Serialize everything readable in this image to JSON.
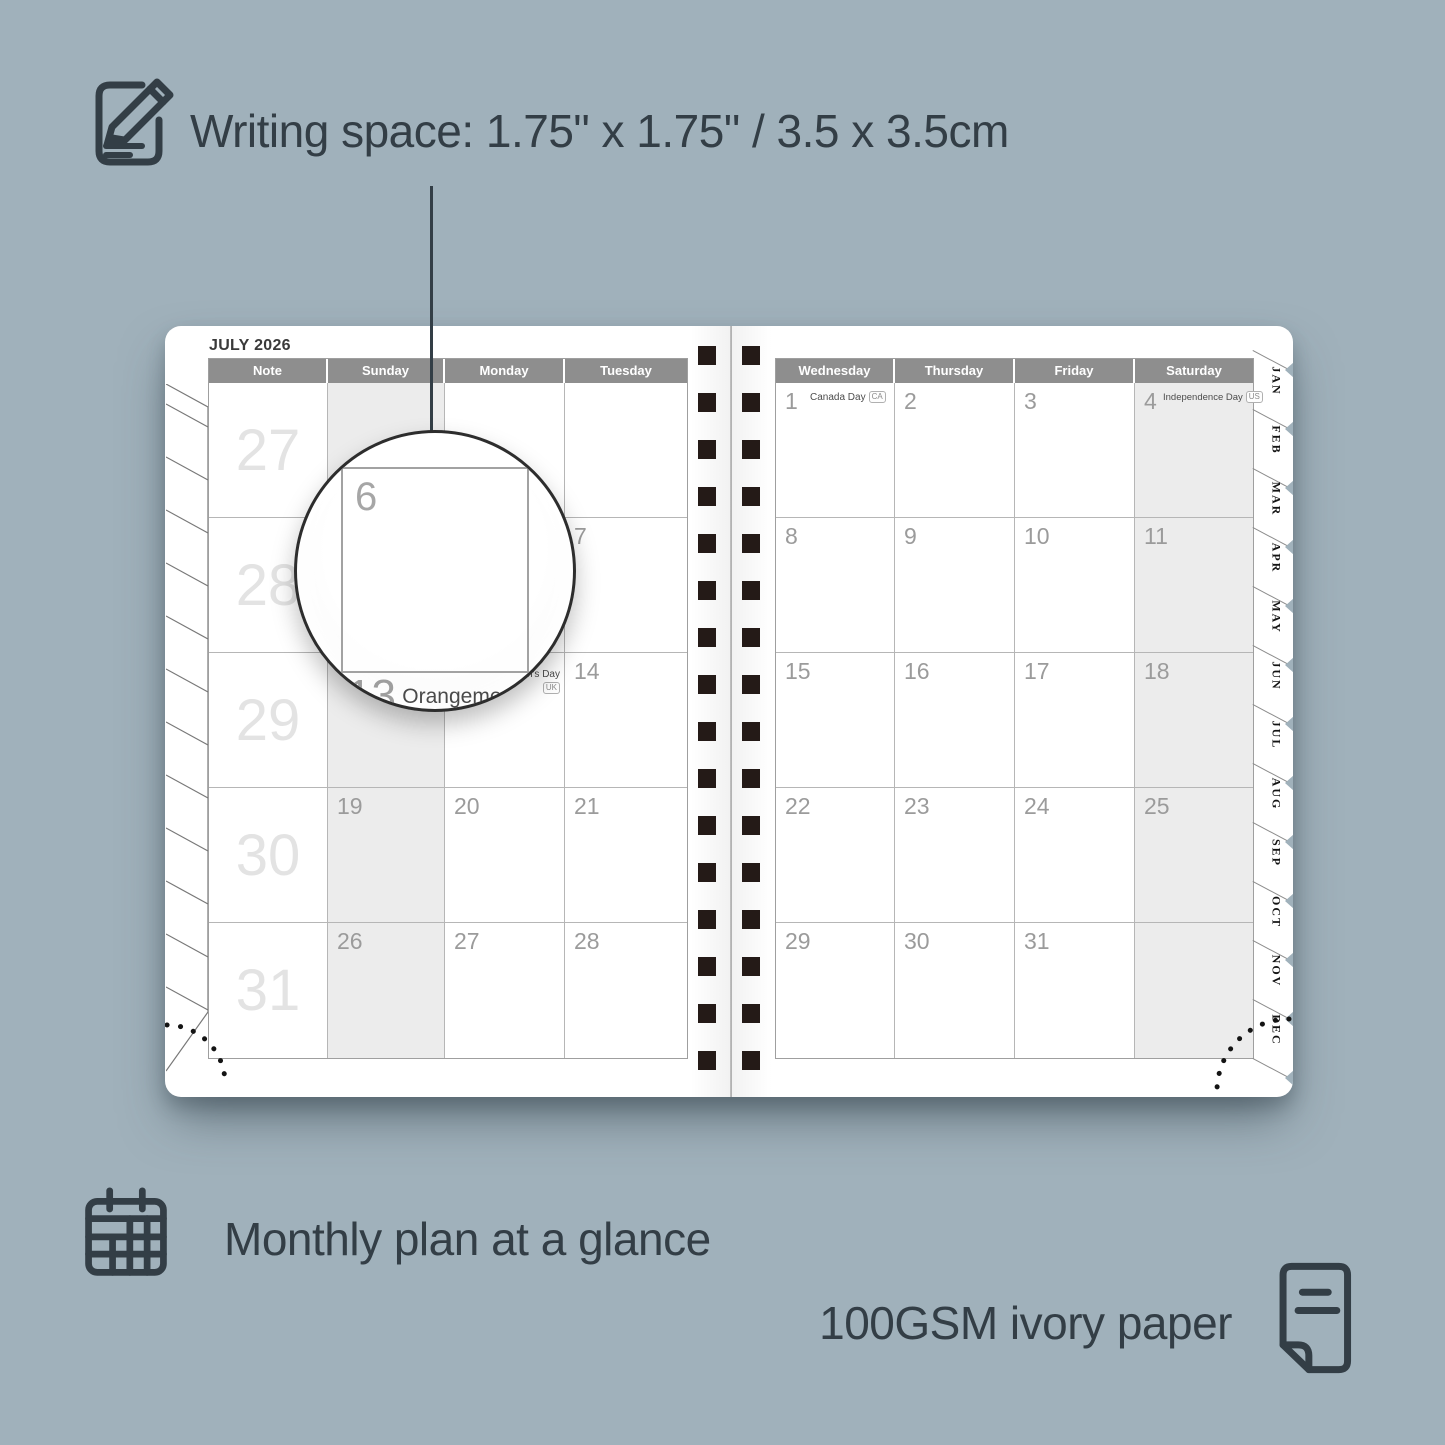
{
  "colors": {
    "background": "#a0b1bb",
    "ink": "#333e46",
    "header_row": "#8e8e8e",
    "shaded_cell": "#ececec",
    "date_number": "#9b9b9b",
    "week_number": "#e3e3e3",
    "spiral_binding": "#241a17"
  },
  "features": {
    "writing_space": {
      "icon": "note-pencil-icon",
      "text": "Writing space: 1.75\" x 1.75\" / 3.5 x 3.5cm"
    },
    "monthly_plan": {
      "icon": "calendar-grid-icon",
      "text": "Monthly plan at a glance"
    },
    "paper": {
      "icon": "paper-sheet-icon",
      "text": "100GSM ivory paper"
    }
  },
  "planner": {
    "title": "JULY 2026",
    "left_page": {
      "headers": [
        "Note",
        "Sunday",
        "Monday",
        "Tuesday"
      ],
      "shaded_column": "Sunday",
      "rows": [
        {
          "week": "27",
          "days": [
            {
              "d": ""
            },
            {
              "d": ""
            },
            {
              "d": ""
            }
          ]
        },
        {
          "week": "28",
          "days": [
            {
              "d": ""
            },
            {
              "d": "6"
            },
            {
              "d": "7"
            }
          ]
        },
        {
          "week": "29",
          "days": [
            {
              "d": ""
            },
            {
              "d": "13",
              "holiday": "Orangemen's Day",
              "badge": "UK"
            },
            {
              "d": "14"
            }
          ]
        },
        {
          "week": "30",
          "days": [
            {
              "d": "19"
            },
            {
              "d": "20"
            },
            {
              "d": "21"
            }
          ]
        },
        {
          "week": "31",
          "days": [
            {
              "d": "26"
            },
            {
              "d": "27"
            },
            {
              "d": "28"
            }
          ]
        }
      ]
    },
    "right_page": {
      "headers": [
        "Wednesday",
        "Thursday",
        "Friday",
        "Saturday"
      ],
      "shaded_column": "Saturday",
      "rows": [
        {
          "days": [
            {
              "d": "1",
              "holiday": "Canada Day",
              "badge": "CA"
            },
            {
              "d": "2"
            },
            {
              "d": "3"
            },
            {
              "d": "4",
              "holiday": "Independence Day",
              "badge": "US",
              "small": true
            }
          ]
        },
        {
          "days": [
            {
              "d": "8"
            },
            {
              "d": "9"
            },
            {
              "d": "10"
            },
            {
              "d": "11"
            }
          ]
        },
        {
          "days": [
            {
              "d": "15"
            },
            {
              "d": "16"
            },
            {
              "d": "17"
            },
            {
              "d": "18"
            }
          ]
        },
        {
          "days": [
            {
              "d": "22"
            },
            {
              "d": "23"
            },
            {
              "d": "24"
            },
            {
              "d": "25"
            }
          ]
        },
        {
          "days": [
            {
              "d": "29"
            },
            {
              "d": "30"
            },
            {
              "d": "31"
            },
            {
              "d": ""
            }
          ]
        }
      ]
    },
    "month_tabs": [
      "JAN",
      "FEB",
      "MAR",
      "APR",
      "MAY",
      "JUN",
      "JUL",
      "AUG",
      "SEP",
      "OCT",
      "NOV",
      "DEC"
    ],
    "magnifier": {
      "top_day": "6",
      "bottom_day": "13",
      "holiday": "Orangemen's Day",
      "holiday_note": "(n.i.)",
      "badge": "UK"
    }
  }
}
